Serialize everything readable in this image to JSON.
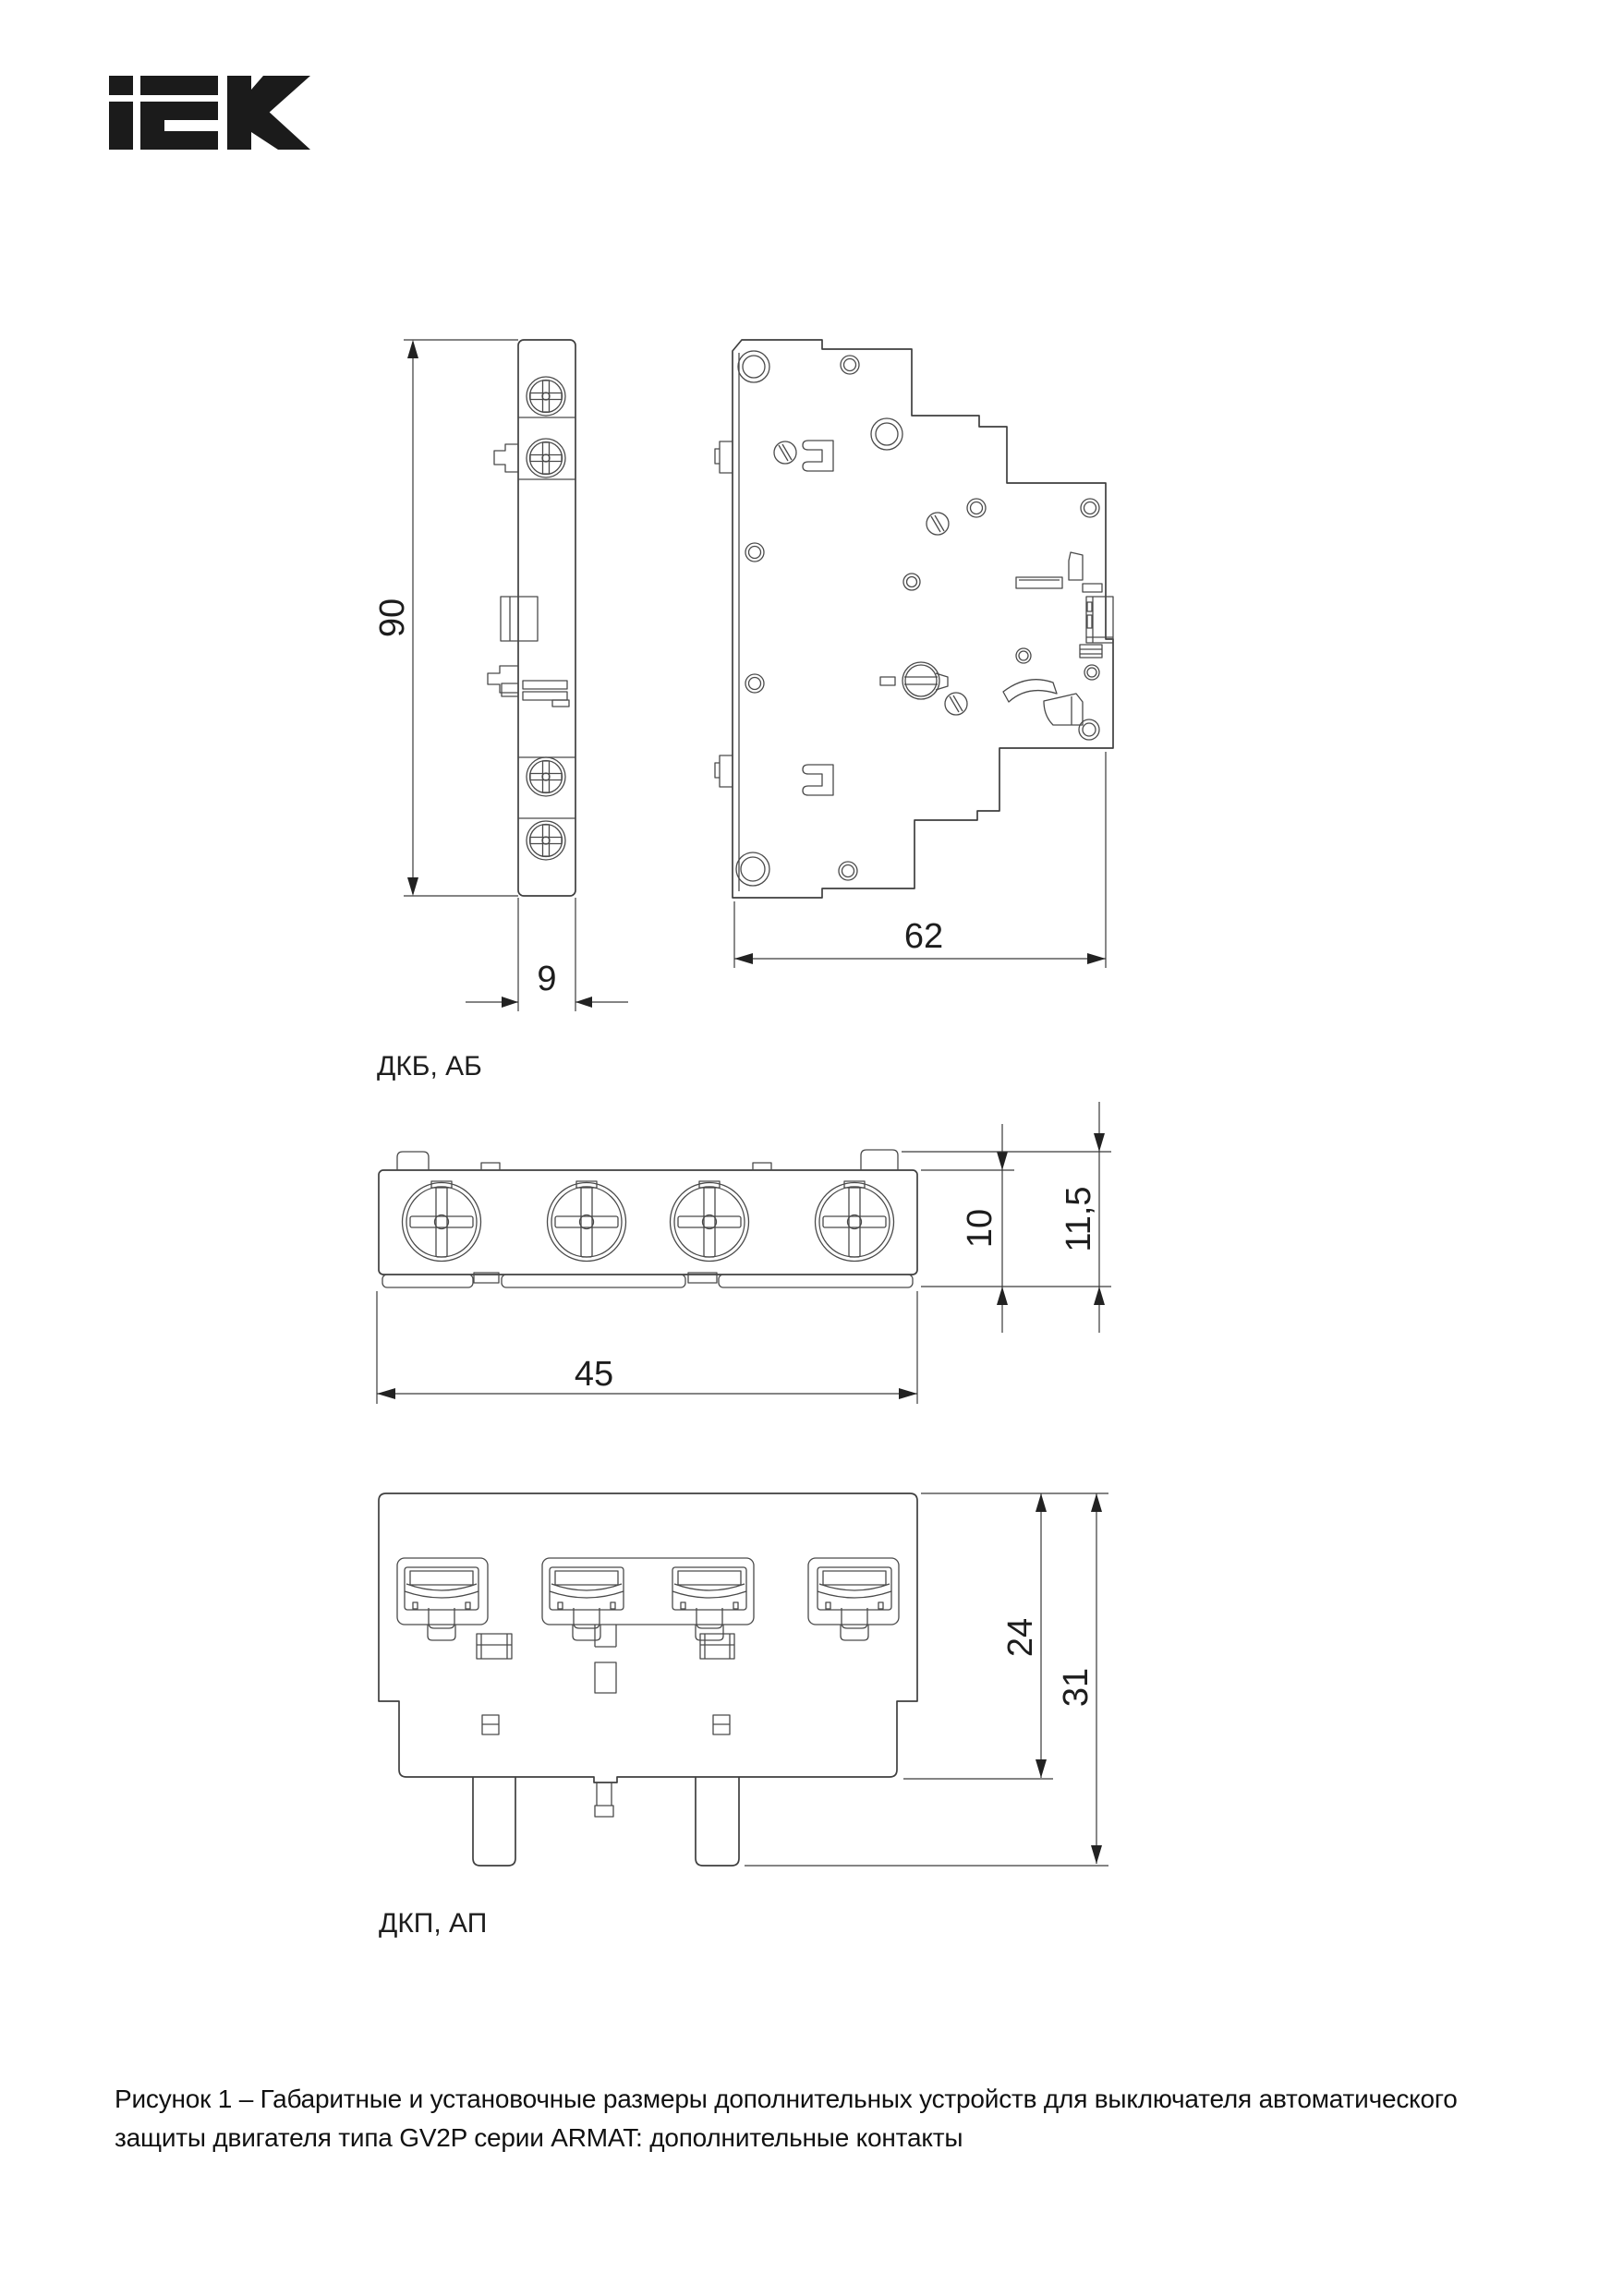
{
  "logo": {
    "brand": "IEK",
    "color": "#1b1b1b"
  },
  "figure": {
    "side_view": {
      "label": "ДКБ, АБ",
      "dim_height": "90",
      "dim_width": "9"
    },
    "profile_view": {
      "dim_width": "62"
    },
    "top_view": {
      "dim_width": "45",
      "dim_height": "10",
      "dim_height_total": "11,5"
    },
    "front_view": {
      "label": "ДКП, АП",
      "dim_height": "24",
      "dim_height_total": "31"
    }
  },
  "caption": {
    "line1": "Рисунок 1 – Габаритные и установочные размеры дополнительных устройств для выключателя автоматического",
    "line2": "защиты двигателя типа GV2P серии ARMAT: дополнительные контакты"
  },
  "colors": {
    "line": "#3f3f3f",
    "text": "#1d1d1d",
    "background": "#ffffff"
  }
}
